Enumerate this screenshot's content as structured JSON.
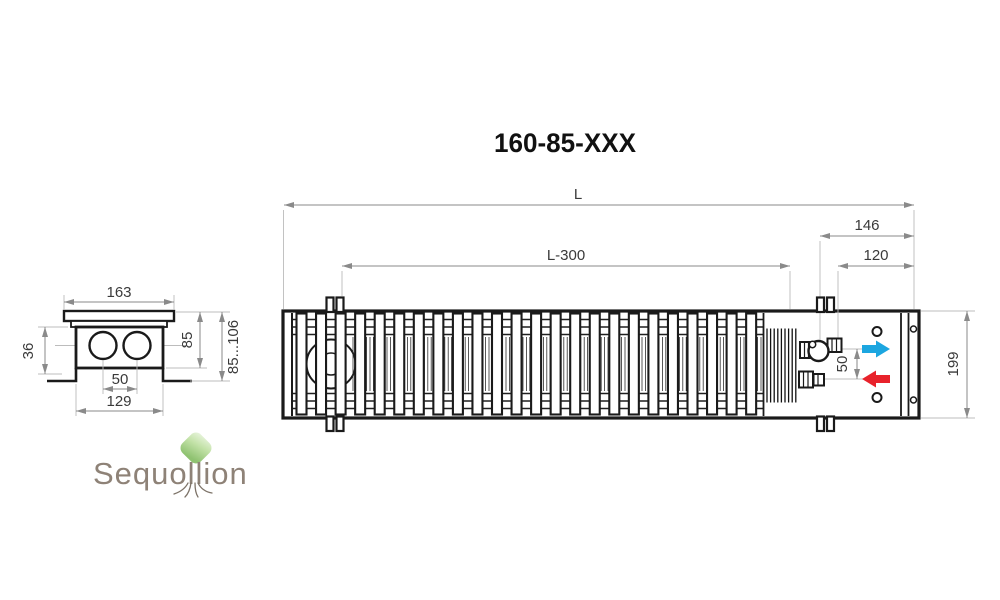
{
  "title": "160-85-XXX",
  "section_view": {
    "top_width": "163",
    "inlet_depth": "36",
    "pipe_spacing": "50",
    "bottom_width": "129",
    "body_height": "85",
    "height_range": "85...106"
  },
  "plan_view": {
    "total_length": "L",
    "grille_length": "L-300",
    "end_section": "146",
    "connection_offset": "120",
    "pipe_spacing": "50",
    "body_width": "199"
  },
  "icons": {
    "supply_arrow": "blue-right-arrow",
    "return_arrow": "red-left-arrow"
  },
  "logo": {
    "brand": "Sequollion"
  },
  "colors": {
    "drawing_line": "#1a1a1a",
    "dimension_line": "#8a8a8a",
    "dimension_text": "#3a3a3a",
    "supply_arrow": "#1ca6e0",
    "return_arrow": "#e8222b",
    "logo_text": "#8e8277",
    "leaf_light": "#e9f5de",
    "leaf_dark": "#8fc271",
    "background": "#ffffff"
  }
}
